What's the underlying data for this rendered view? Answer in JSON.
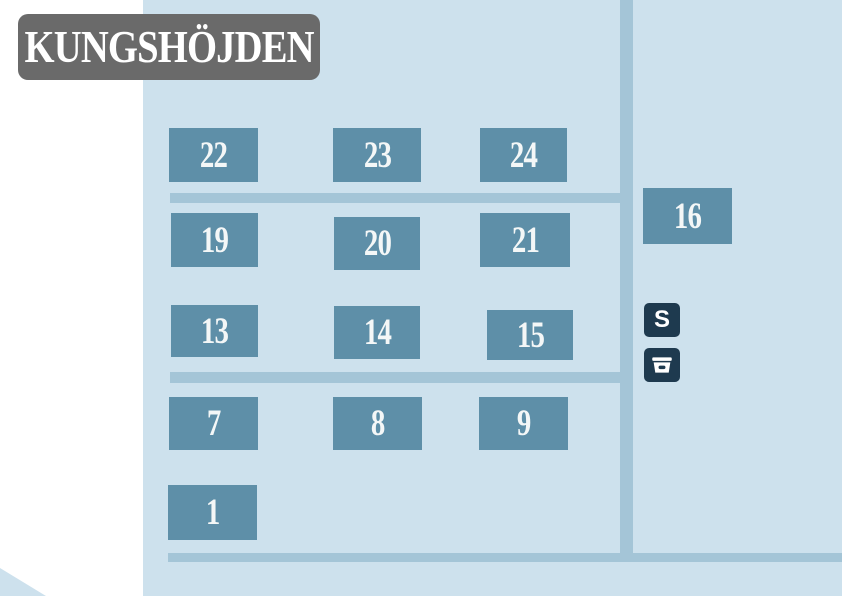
{
  "title": "KUNGSHÖJDEN",
  "colors": {
    "background": "#ffffff",
    "map": "#cde1ed",
    "road": "#a4c5d7",
    "building": "#5e8fa8",
    "badge": "#1e3a4f",
    "title_bg": "#6a6a6a",
    "text": "#f4f7f7"
  },
  "buildings": [
    {
      "label": "22"
    },
    {
      "label": "23"
    },
    {
      "label": "24"
    },
    {
      "label": "16"
    },
    {
      "label": "19"
    },
    {
      "label": "20"
    },
    {
      "label": "21"
    },
    {
      "label": "13"
    },
    {
      "label": "14"
    },
    {
      "label": "15"
    },
    {
      "label": "7"
    },
    {
      "label": "8"
    },
    {
      "label": "9"
    },
    {
      "label": "1"
    }
  ],
  "legend": {
    "s_label": "S"
  }
}
